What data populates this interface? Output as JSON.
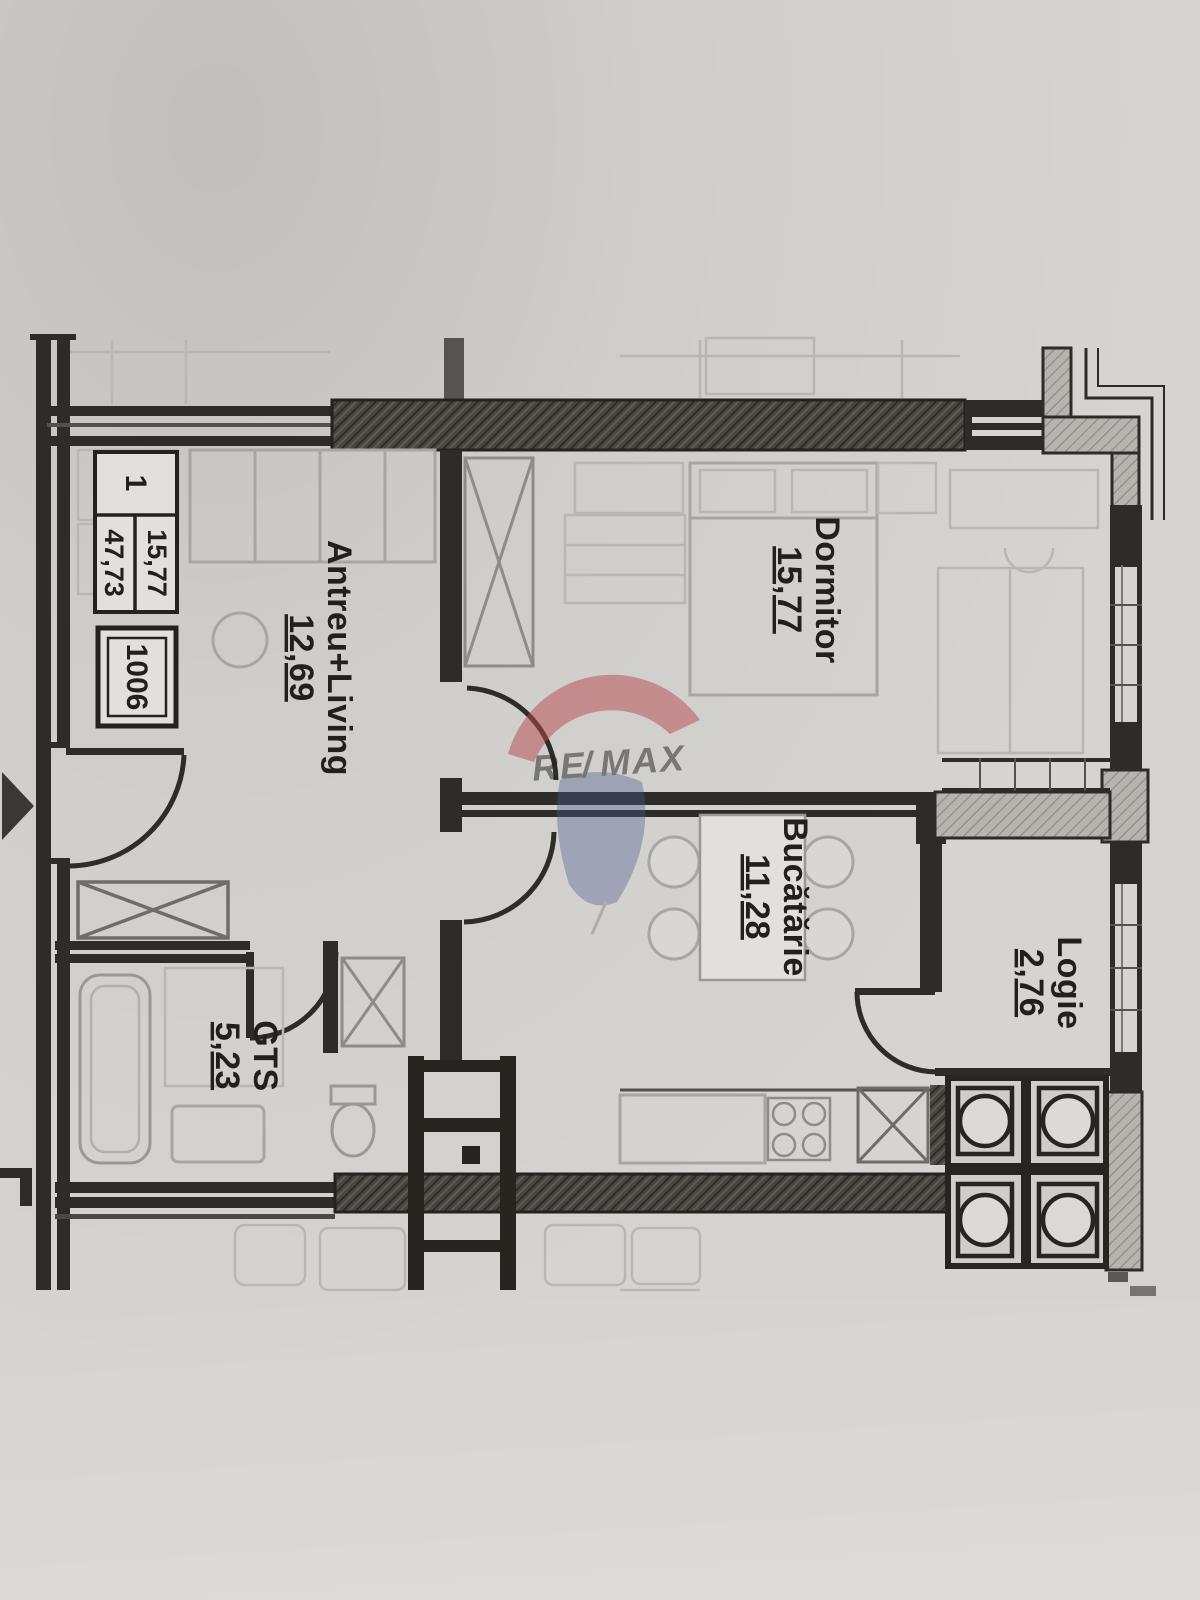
{
  "unit_info_box": {
    "rooms_count": "1",
    "area_living": "15,77",
    "area_total": "47,73",
    "apartment_number": "1006"
  },
  "rooms": [
    {
      "key": "antreu",
      "name": "Antreu+Living",
      "area": "12,69"
    },
    {
      "key": "dormitor",
      "name": "Dormitor",
      "area": "15,77"
    },
    {
      "key": "bucatarie",
      "name": "Bucătărie",
      "area": "11,28"
    },
    {
      "key": "logie",
      "name": "Logie",
      "area": "2,76"
    },
    {
      "key": "gts",
      "name": "GTS",
      "area": "5,23"
    }
  ],
  "watermark": {
    "re": "RE",
    "slash": "/",
    "max": "MAX"
  },
  "colors": {
    "wall": "#2e2c29",
    "paper": "#d6d4d0",
    "furniture_faint": "#a5a29e",
    "watermark_red": "#bf4a52",
    "watermark_blue": "#4a5c90"
  }
}
